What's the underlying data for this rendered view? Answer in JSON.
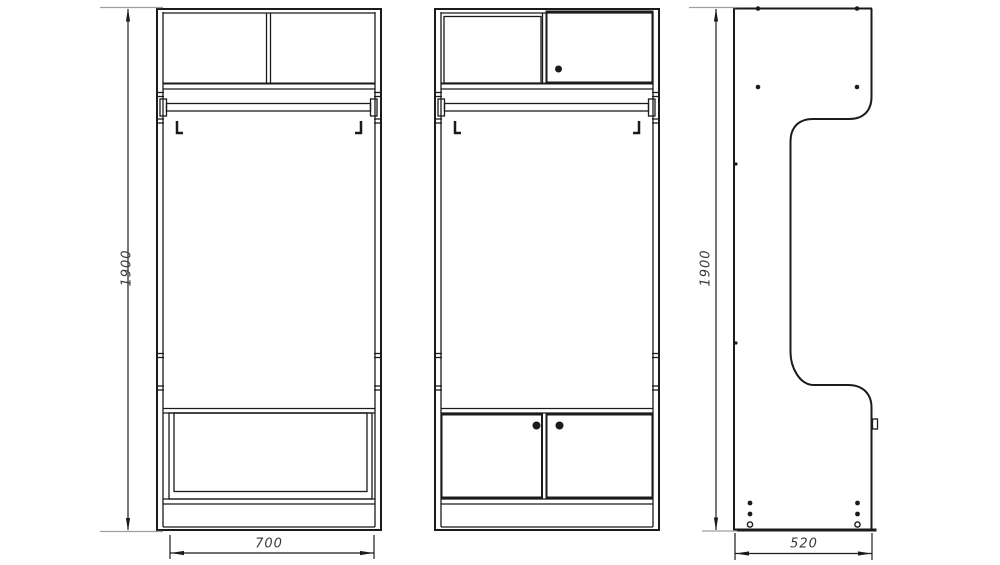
{
  "drawing": {
    "colors": {
      "background": "#ffffff",
      "line": "#1b1b1b",
      "extension_line": "#9aa0a6",
      "dimension_text": "#3a3a3a"
    },
    "dimensions": {
      "front_height": "1900",
      "front_width": "700",
      "side_height": "1900",
      "side_depth": "520"
    }
  }
}
